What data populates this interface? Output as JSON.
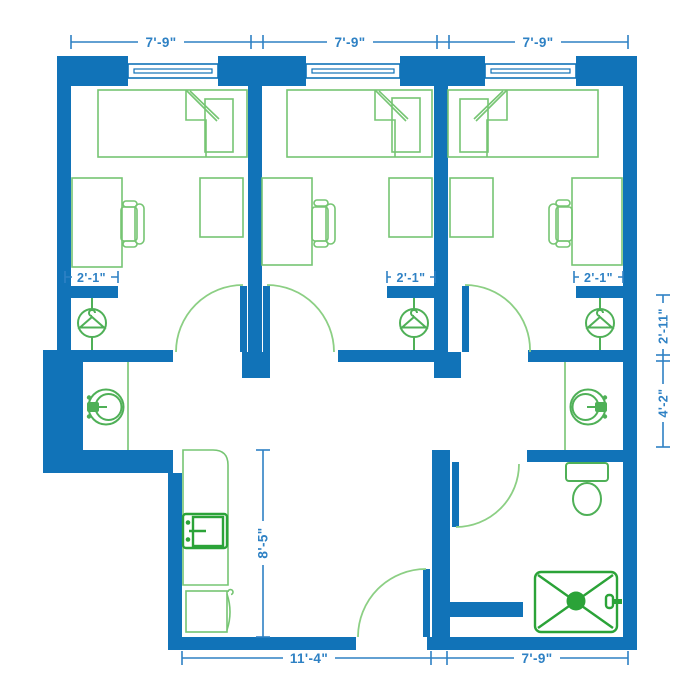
{
  "title": "Three-bedroom suite floor plan",
  "colors": {
    "wall": "#1173b8",
    "dimension": "#2e81c4",
    "furniture": "#76c573",
    "accent_green": "#4fb057",
    "fixture": "#2ba338",
    "door_arc": "#8ccf84",
    "background": "#ffffff"
  },
  "dimensions": {
    "top": [
      {
        "label": "7'-9\""
      },
      {
        "label": "7'-9\""
      },
      {
        "label": "7'-9\""
      }
    ],
    "closets": [
      {
        "label": "2'-1\""
      },
      {
        "label": "2'-1\""
      },
      {
        "label": "2'-1\""
      }
    ],
    "right_side": [
      {
        "label": "2'-11\""
      },
      {
        "label": "4'-2\""
      }
    ],
    "kitchen": {
      "label": "8'-5\""
    },
    "bottom": [
      {
        "label": "11'-4\""
      },
      {
        "label": "7'-9\""
      }
    ]
  },
  "fixtures": {
    "bedrooms": [
      "bed-icon",
      "pillow-icon",
      "desk-icon",
      "desk-chair-icon",
      "side-table-icon",
      "hanger-icon",
      "window-icon",
      "door-swing-icon"
    ],
    "bath_and_kitchen": [
      "vanity-sink-icon",
      "vanity-sink-icon",
      "kitchen-sink-icon",
      "refrigerator-icon",
      "toilet-icon",
      "shower-icon",
      "shower-head-icon",
      "door-swing-icon"
    ]
  }
}
